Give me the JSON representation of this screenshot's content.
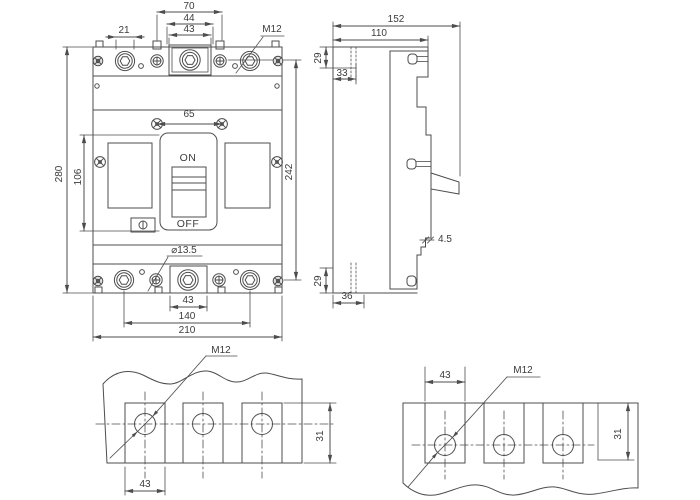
{
  "front_view": {
    "dims": {
      "d70": "70",
      "d44": "44",
      "d43_top": "43",
      "d21": "21",
      "m12_top": "M12",
      "d65": "65",
      "d280": "280",
      "d106": "106",
      "d242": "242",
      "dia_13_5": "⌀13.5",
      "d43_bottom": "43",
      "d140": "140",
      "d210": "210"
    },
    "switch": {
      "on_label": "ON",
      "off_label": "OFF"
    }
  },
  "side_view": {
    "dims": {
      "d152": "152",
      "d110": "110",
      "d29_top": "29",
      "d33": "33",
      "d4_5": "4.5",
      "d29_bottom": "29",
      "d36": "36"
    }
  },
  "detail_bottom_left": {
    "dims": {
      "m12": "M12",
      "d43": "43",
      "d31": "31"
    }
  },
  "detail_bottom_right": {
    "dims": {
      "d43": "43",
      "m12": "M12",
      "d31": "31"
    }
  },
  "colors": {
    "line": "#4d4d4d",
    "text": "#3c3c3c",
    "background": "#ffffff"
  }
}
